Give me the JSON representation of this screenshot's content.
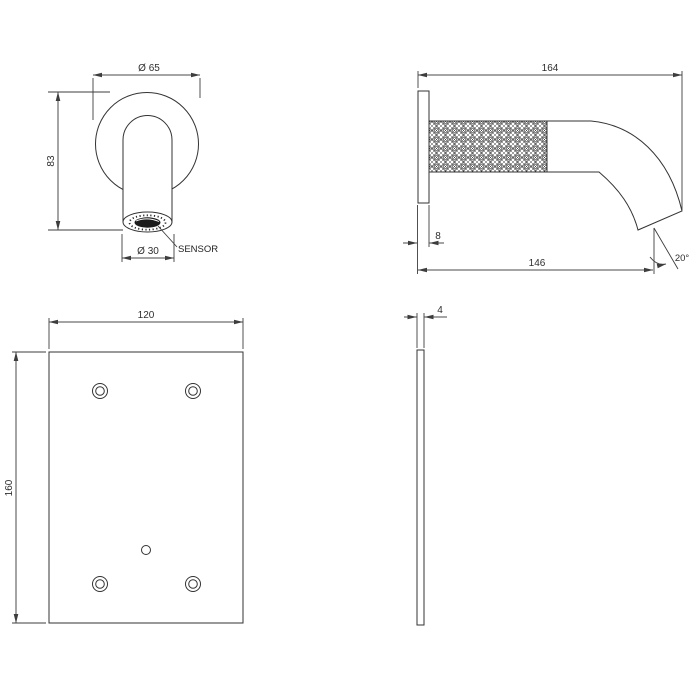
{
  "drawing": {
    "front_view": {
      "dim_flange_diameter": "Ø 65",
      "dim_height": "83",
      "dim_outlet_diameter": "Ø 30",
      "sensor_label": "SENSOR"
    },
    "side_view": {
      "dim_total_length": "164",
      "dim_wall_plate_thickness": "8",
      "dim_spout_reach": "146",
      "dim_outlet_angle": "20°"
    },
    "plate_front_view": {
      "dim_width": "120",
      "dim_height": "160"
    },
    "plate_side_view": {
      "dim_thickness": "4"
    },
    "colors": {
      "object_line": "#333333",
      "dimension_line": "#4a4a4a",
      "text": "#2e2e2e",
      "background": "#ffffff",
      "aerator_fill": "#1c1c1c"
    }
  }
}
